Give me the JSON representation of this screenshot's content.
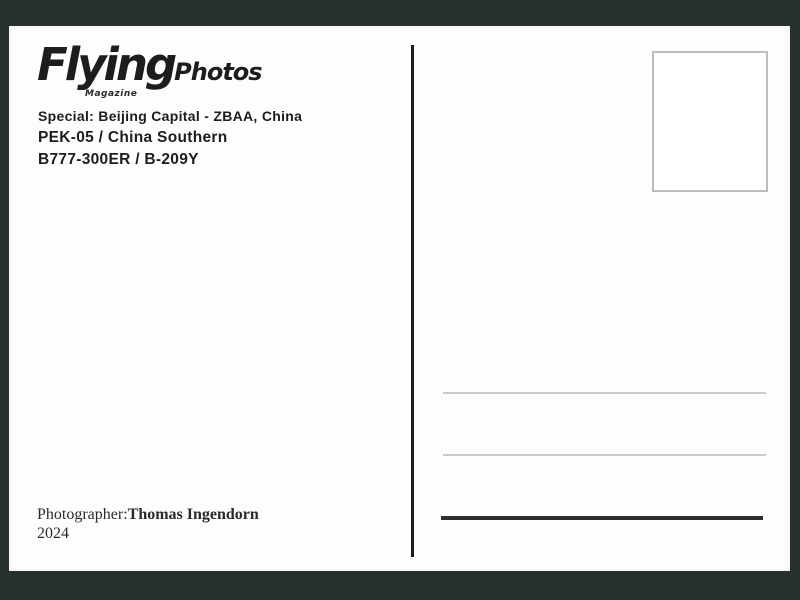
{
  "meta": {
    "description": "Scanned back of a FlyingPhotos Magazine collector postcard",
    "colors": {
      "surround_background": "#27302a",
      "card_background": "#fdfdfd",
      "text": "#1d1d1d",
      "divider": "#1c1c1c",
      "stamp_border": "#b9bdbe",
      "address_line_light": "#c9cccc",
      "address_line_dark": "#2e2e2e"
    }
  },
  "logo": {
    "brand": "Flying",
    "suffix": "Photos",
    "tagline": "Magazine"
  },
  "details": {
    "special_line": "Special: Beijing Capital - ZBAA, China",
    "flight_line": "PEK-05 / China Southern",
    "aircraft_line": "B777-300ER / B-209Y"
  },
  "credit": {
    "label": "Photographer:",
    "name": "Thomas Ingendorn",
    "year": "2024"
  }
}
